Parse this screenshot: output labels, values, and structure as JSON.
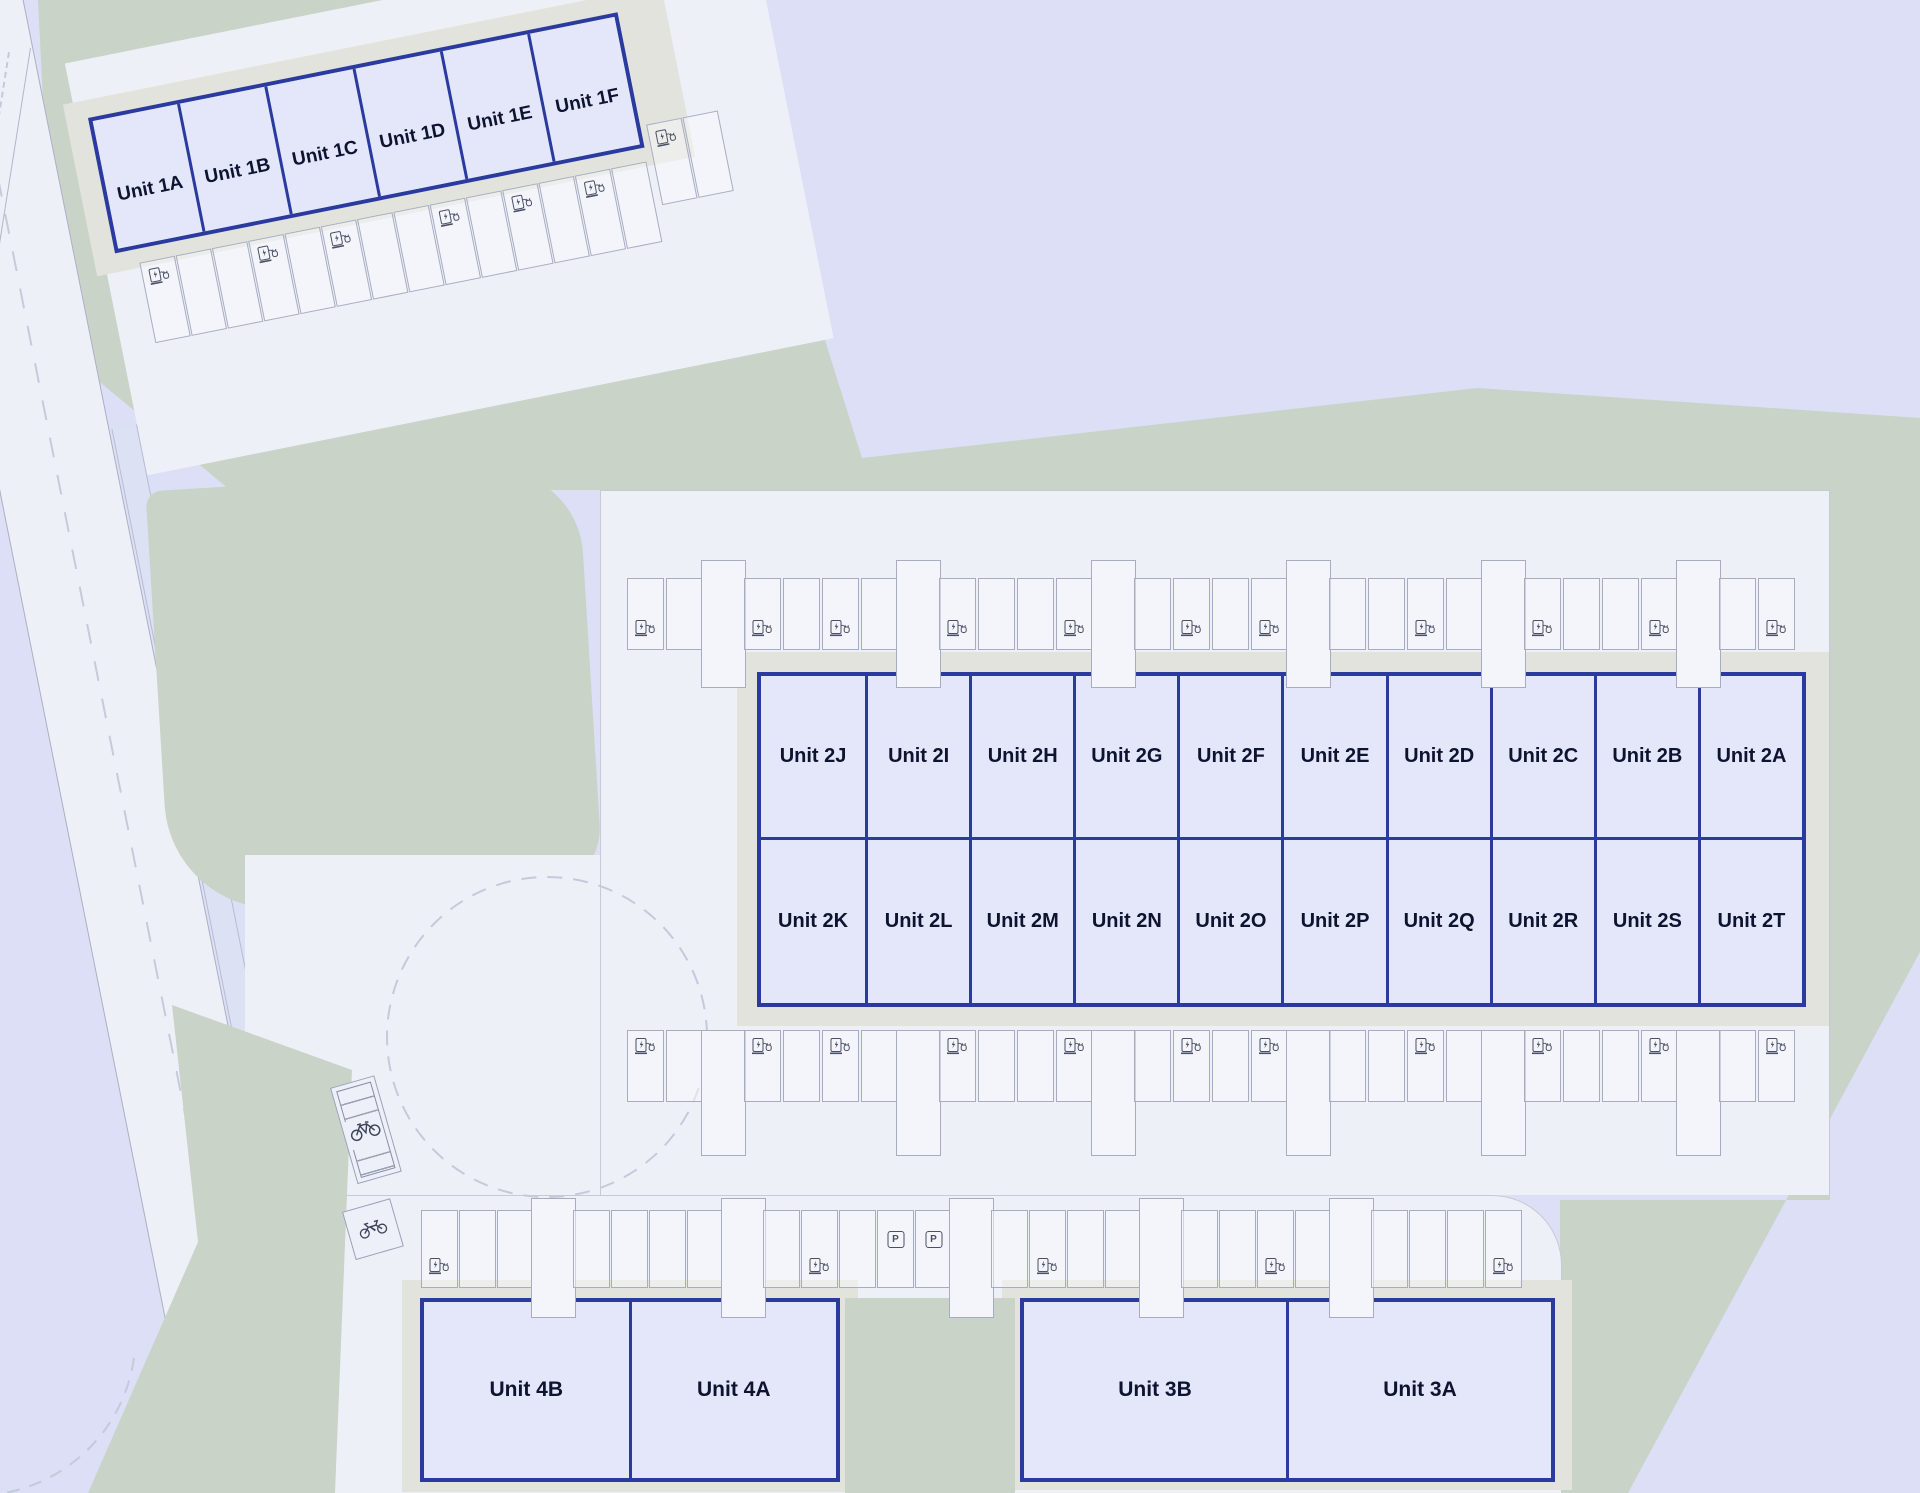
{
  "site": {
    "type": "industrial-estate-site-plan"
  },
  "colors": {
    "background": "#dcdff6",
    "grass": "#cad3c7",
    "pavement": "#eef0f8",
    "footpath": "#dde1f4",
    "building_pad": "#e3e3dd",
    "building_fill": "#e4e7fa",
    "building_border": "#2a3a9e",
    "unit_label": "#0e1330",
    "stall_line": "#a7acc1",
    "road_marking": "#c6cada",
    "icon": "#4a5065"
  },
  "blocks": {
    "block1": {
      "units": [
        "Unit 1A",
        "Unit 1B",
        "Unit 1C",
        "Unit 1D",
        "Unit 1E",
        "Unit 1F"
      ]
    },
    "block2": {
      "row_top": [
        "Unit 2J",
        "Unit 2I",
        "Unit 2H",
        "Unit 2G",
        "Unit 2F",
        "Unit 2E",
        "Unit 2D",
        "Unit 2C",
        "Unit 2B",
        "Unit 2A"
      ],
      "row_bottom": [
        "Unit 2K",
        "Unit 2L",
        "Unit 2M",
        "Unit 2N",
        "Unit 2O",
        "Unit 2P",
        "Unit 2Q",
        "Unit 2R",
        "Unit 2S",
        "Unit 2T"
      ]
    },
    "block3": {
      "units": [
        "Unit 3B",
        "Unit 3A"
      ]
    },
    "block4": {
      "units": [
        "Unit 4B",
        "Unit 4A"
      ]
    }
  },
  "parking": {
    "zone1_row": {
      "stalls": 16,
      "tall_indices": [],
      "ev_indices": [
        0,
        3,
        5,
        8,
        10,
        12,
        14
      ],
      "stagger_from": 14
    },
    "zone2_top_row": {
      "stalls": 30,
      "tall_indices": [
        2,
        7,
        12,
        17,
        22,
        27
      ],
      "ev_indices": [
        0,
        3,
        5,
        8,
        11,
        14,
        16,
        20,
        23,
        26,
        29
      ]
    },
    "zone2_bottom_row": {
      "stalls": 30,
      "tall_indices": [
        2,
        7,
        12,
        17,
        22,
        27
      ],
      "ev_indices": [
        0,
        3,
        5,
        8,
        11,
        14,
        16,
        20,
        23,
        26,
        29
      ]
    },
    "zone3_row": {
      "stalls": 29,
      "tall_indices": [
        3,
        8,
        14,
        19,
        24
      ],
      "ev_indices": [
        0,
        10,
        16,
        22,
        28
      ],
      "p_indices": [
        12,
        13
      ]
    }
  },
  "icons": {
    "ev": "ev-charging-station-icon",
    "p_label": "P",
    "bike": "bicycle-icon",
    "moto": "motorcycle-icon"
  },
  "road": {
    "roundabout": true,
    "centerline": "dashed"
  }
}
